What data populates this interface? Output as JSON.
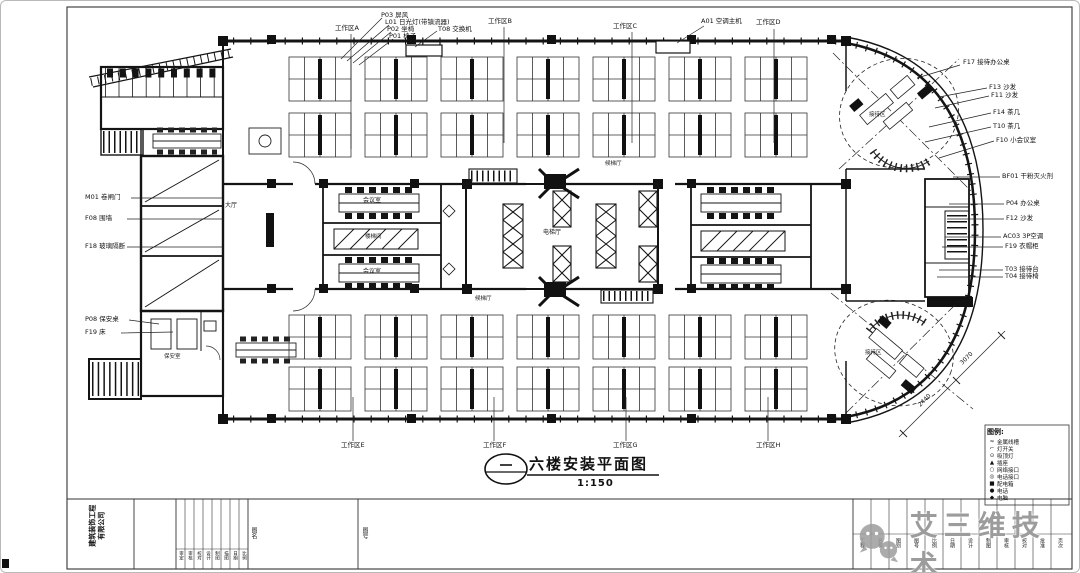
{
  "meta": {
    "drawing_title": "六楼安装平面图",
    "drawing_scale": "1:150"
  },
  "callouts": {
    "top_stack": [
      "P03 屏风",
      "L01 日光灯(带镇流器)",
      "P02 坐椅",
      "P01 椅子"
    ],
    "top_switch": "T08 交换机",
    "top_ac": "A01 空调主机",
    "work_areas_top": [
      "工作区A",
      "工作区B",
      "工作区C",
      "工作区D"
    ],
    "work_areas_bottom": [
      "工作区E",
      "工作区F",
      "工作区G",
      "工作区H"
    ],
    "left": [
      "M01 卷闸门",
      "F08 围墙",
      "F18 玻璃隔断",
      "P08 保安桌",
      "F19 床"
    ],
    "right_top": [
      "F17 接待办公桌",
      "F13 沙发",
      "F11 沙发",
      "F14 茶几",
      "T10 茶几",
      "F10 小会议室"
    ],
    "right_mid": [
      "BF01 干粉灭火剂",
      "P04 办公桌",
      "F12 沙发",
      "AC03 3P空调",
      "F19 衣帽柜",
      "T03 接待台",
      "T04 接待椅"
    ]
  },
  "rooms": {
    "lobby": "大厅",
    "elevator_hall": "电梯厅",
    "wait_top": "候梯厅",
    "wait_bottom": "候梯厅",
    "meeting_1": "会议室",
    "meeting_2": "会议室",
    "stair": "楼梯间",
    "security": "保安室",
    "reception_top": "接待区",
    "reception_bottom": "接待区"
  },
  "dimensions": [
    "2440",
    "3070"
  ],
  "legend": {
    "title": "图例:",
    "items": [
      {
        "sym": "≈",
        "label": "金属线槽"
      },
      {
        "sym": "⌐",
        "label": "灯开关"
      },
      {
        "sym": "⊙",
        "label": "吸顶灯"
      },
      {
        "sym": "▲",
        "label": "插座"
      },
      {
        "sym": "○",
        "label": "网络接口"
      },
      {
        "sym": "◎",
        "label": "电话接口"
      },
      {
        "sym": "■",
        "label": "配电箱"
      },
      {
        "sym": "●",
        "label": "电话"
      },
      {
        "sym": "◆",
        "label": "电脑"
      }
    ]
  },
  "title_block": {
    "company_line1": "建筑装饰工程",
    "company_line2": "有限公司",
    "sign_cells": [
      "审定",
      "审核",
      "校对",
      "设计",
      "制图",
      "描图",
      "日期",
      "比例"
    ],
    "col_label1": "图名",
    "col_label2": "图号",
    "right_columns": [
      "工程",
      "名称",
      "图别",
      "图号",
      "比例",
      "日期",
      "设计",
      "制图",
      "审核",
      "校对",
      "批准",
      "页次"
    ]
  },
  "watermark": {
    "text": "艾三维技术"
  }
}
